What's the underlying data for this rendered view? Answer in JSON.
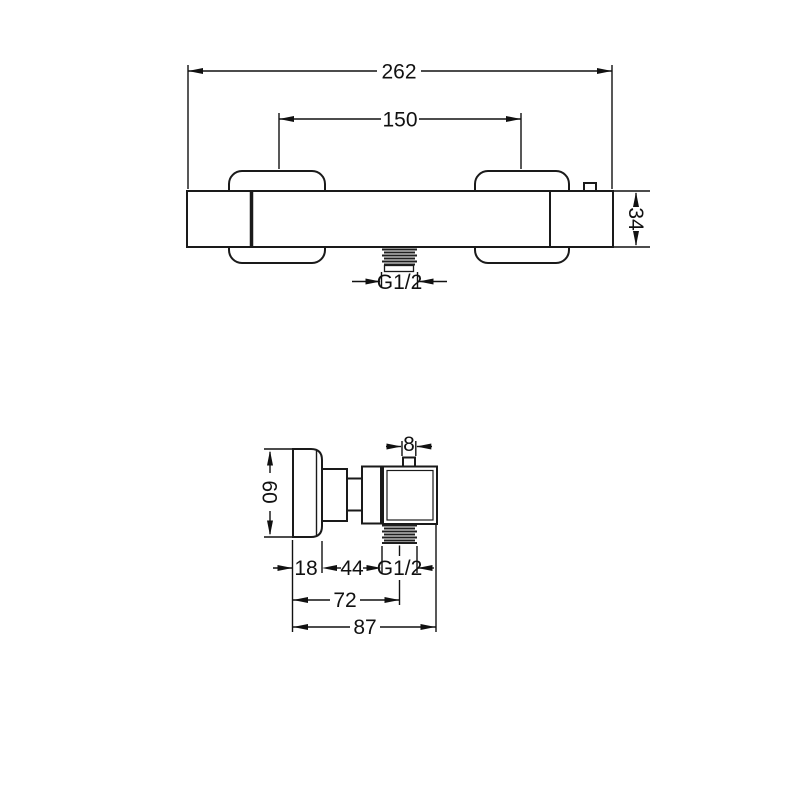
{
  "drawing": {
    "title": "shower-mixer-dimension-drawing",
    "background": "#ffffff",
    "line_color": "#1a1a1a",
    "views": {
      "front": {
        "name": "front-view",
        "dim_overall_width": "262",
        "dim_mounting_centers": "150",
        "dim_body_height": "34",
        "dim_outlet_thread": "G1/2"
      },
      "side": {
        "name": "side-view",
        "dim_top_port_width": "8",
        "dim_handle_height": "60",
        "dim_handle_depth": "18",
        "dim_body_depth": "44",
        "dim_outlet_thread": "G1/2",
        "dim_depth_to_outlet_axis": "72",
        "dim_overall_depth": "87"
      }
    }
  }
}
